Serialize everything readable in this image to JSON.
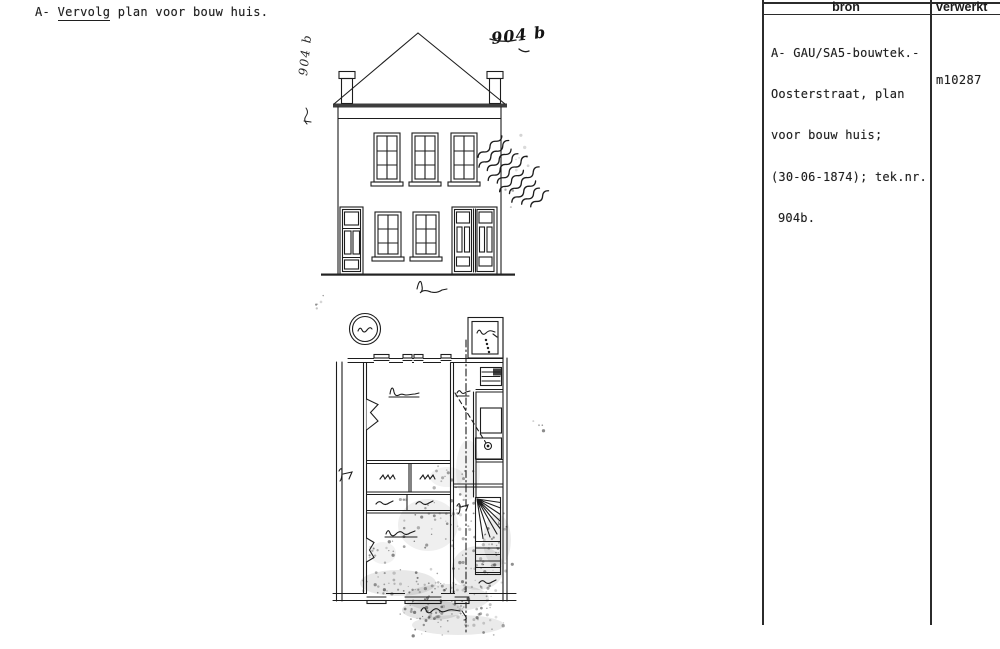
{
  "page": {
    "title": {
      "prefix": "A- ",
      "underlined": "Vervolg",
      "rest": " plan voor bouw huis."
    }
  },
  "table": {
    "columns": [
      {
        "label": "bron"
      },
      {
        "label": "verwerkt"
      }
    ],
    "rows": [
      {
        "bron_lines": [
          "A- GAU/SA5-bouwtek.-",
          "Oosterstraat, plan",
          "voor bouw huis;",
          "(30-06-1874); tek.nr.",
          "904b."
        ],
        "verwerkt": "m10287"
      }
    ]
  },
  "drawing": {
    "sheet_number_top_right": "904 b",
    "sheet_number_left_margin": "904 b",
    "description": "Front elevation (gevel) and ground floor plan of a house; pen drawing photocopy with handwritten annotations"
  },
  "colors": {
    "ink": "#1d1d1d",
    "paper": "#ffffff"
  }
}
